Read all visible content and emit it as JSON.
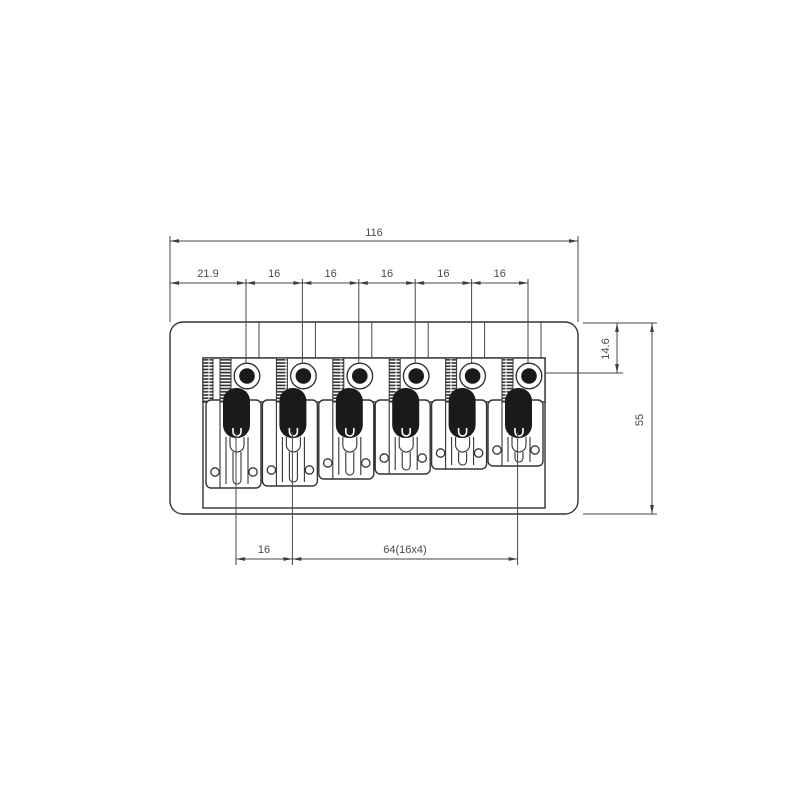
{
  "page": {
    "background": "#ffffff"
  },
  "drawing": {
    "strings_count": 6,
    "dimensions": {
      "overall_width": "116",
      "first_string_offset": "21.9",
      "string_spacings": [
        "16",
        "16",
        "16",
        "16",
        "16"
      ],
      "top_edge_to_string_holes": "14.6",
      "overall_depth": "55",
      "screw_spacing": "16",
      "screw_span": "64(16x4)"
    },
    "colors": {
      "outline": "#333333",
      "annotation": "#454545",
      "label_text": "#4a4a4a",
      "fill": "#ffffff",
      "hardware_black": "#1a1a1a"
    }
  }
}
